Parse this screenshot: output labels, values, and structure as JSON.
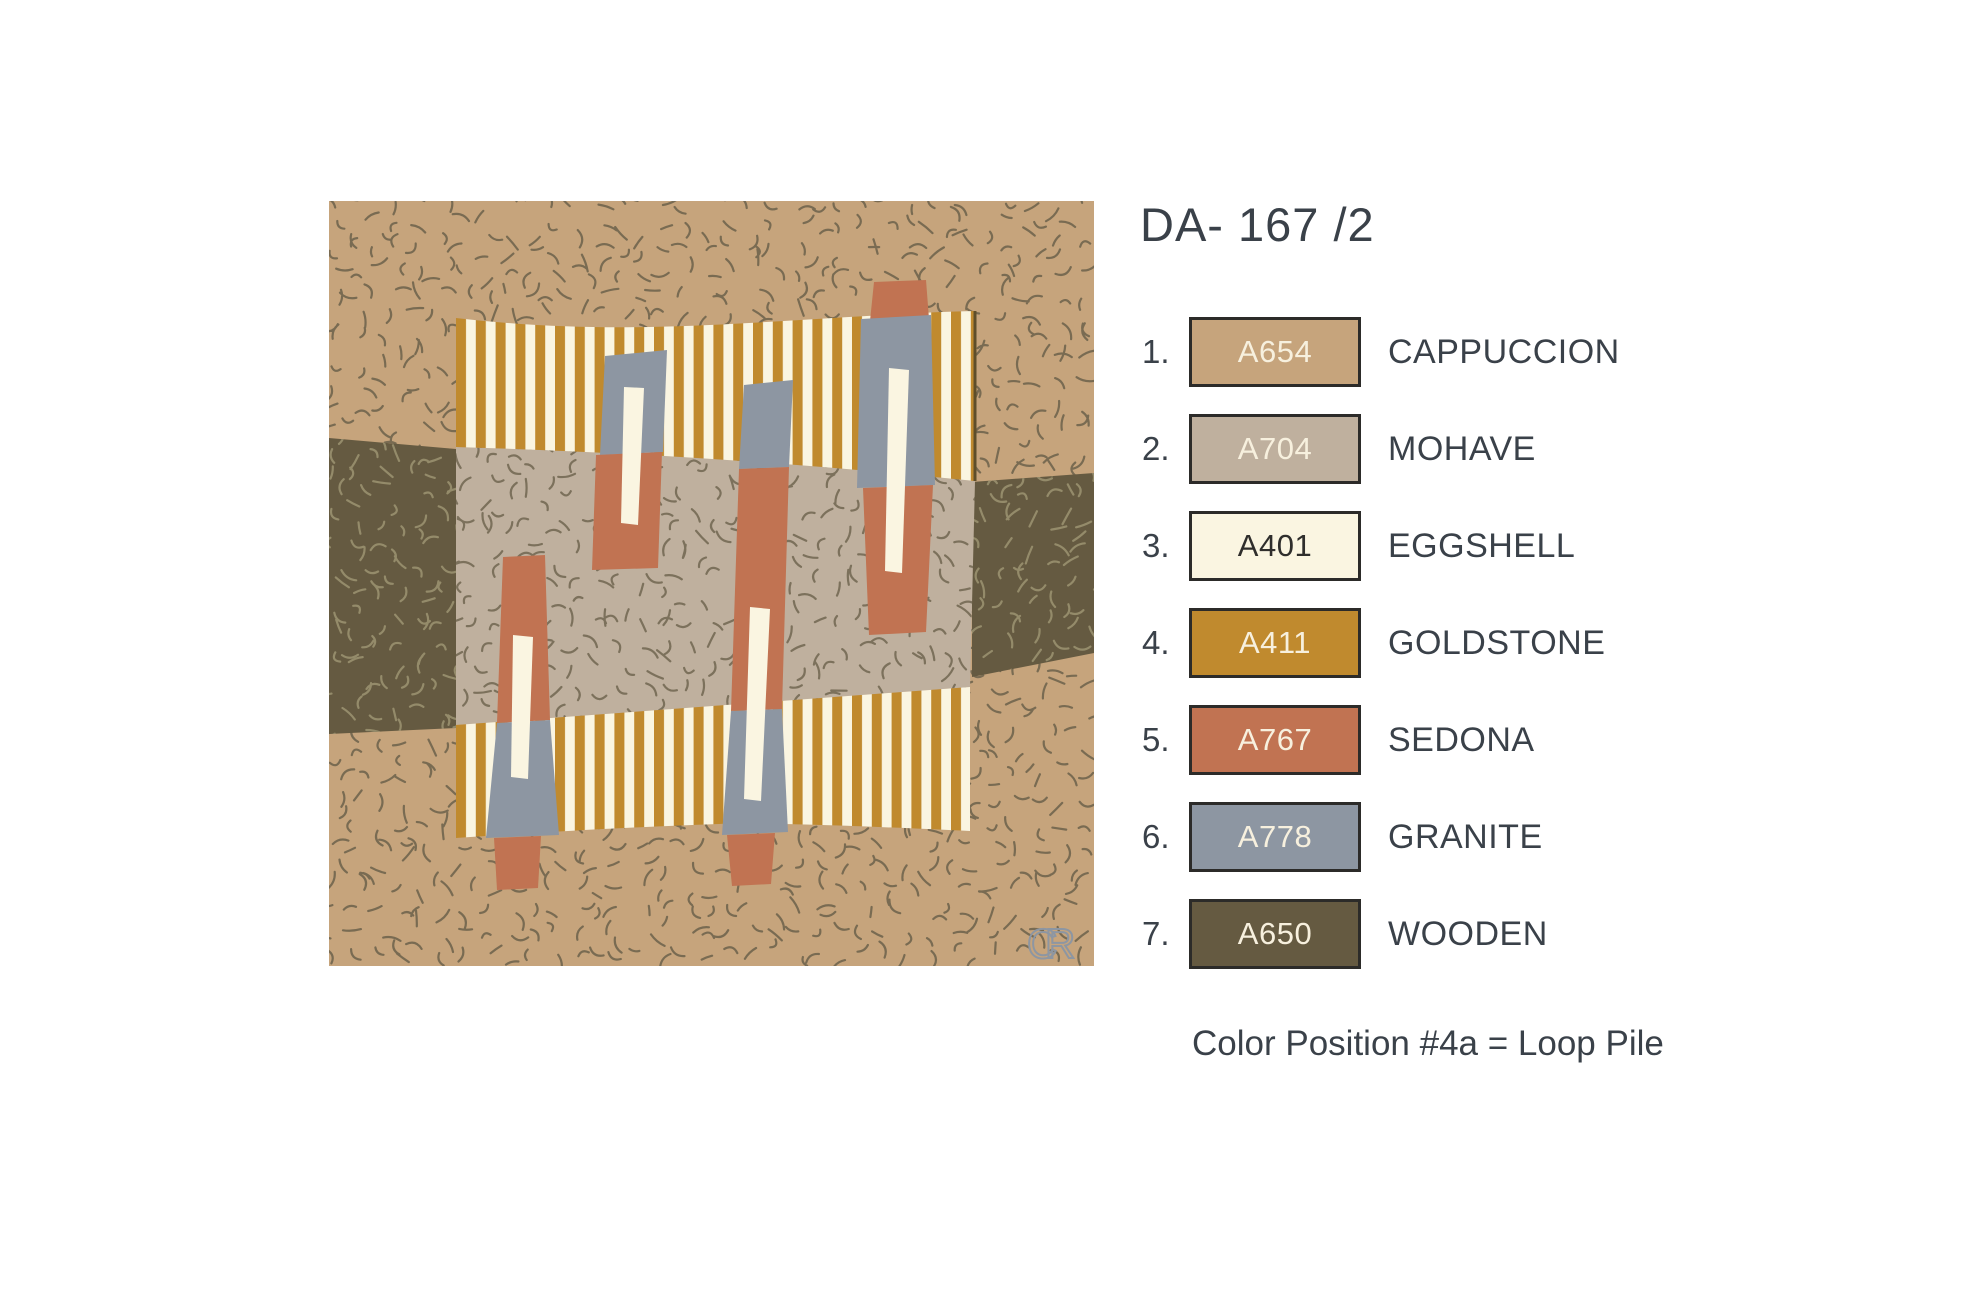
{
  "title": "DA- 167 /2",
  "legend": {
    "items": [
      {
        "num": "1.",
        "code": "A654",
        "name": "CAPPUCCION",
        "color": "#C6A47C",
        "text_color": "#F7F0DE"
      },
      {
        "num": "2.",
        "code": "A704",
        "name": "MOHAVE",
        "color": "#BFB09E",
        "text_color": "#F7F0DE"
      },
      {
        "num": "3.",
        "code": "A401",
        "name": "EGGSHELL",
        "color": "#FAF5E1",
        "text_color": "#2F2E2C"
      },
      {
        "num": "4.",
        "code": "A411",
        "name": "GOLDSTONE",
        "color": "#C08A2E",
        "text_color": "#F7F0DE"
      },
      {
        "num": "5.",
        "code": "A767",
        "name": "SEDONA",
        "color": "#C17352",
        "text_color": "#F7F0DE"
      },
      {
        "num": "6.",
        "code": "A778",
        "name": "GRANITE",
        "color": "#8D96A2",
        "text_color": "#F7F0DE"
      },
      {
        "num": "7.",
        "code": "A650",
        "name": "WOODEN",
        "color": "#655A41",
        "text_color": "#F7F0DE"
      }
    ]
  },
  "note": "Color Position #4a = Loop Pile",
  "monogram": "CR",
  "swatch": {
    "squiggle_dark": "#6B614B",
    "squiggle_light": "#99906F"
  }
}
